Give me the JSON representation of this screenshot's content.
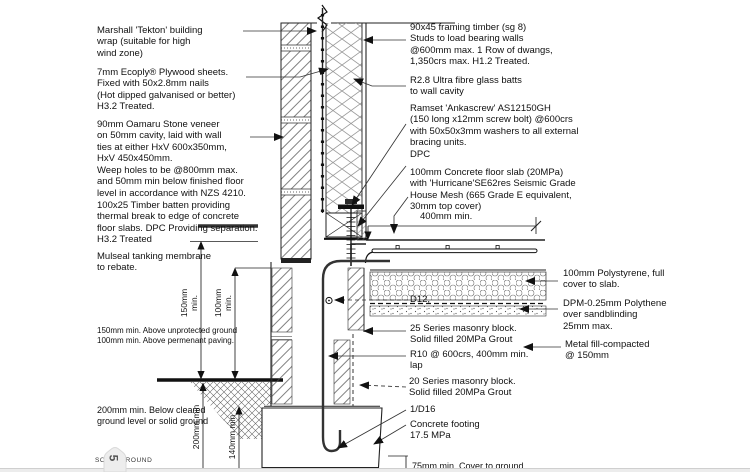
{
  "colors": {
    "ink": "#111111",
    "hatch": "#4a4a4a",
    "background": "#ffffff",
    "footer_strip": "#ececec",
    "pin_fill": "#ededed"
  },
  "left": {
    "building_wrap": "Marshall 'Tekton' building\nwrap (suitable for high\nwind zone)",
    "plywood": "7mm Ecoply® Plywood sheets.\nFixed with 50x2.8mm nails\n(Hot dipped galvanised or better)\nH3.2 Treated.",
    "stone_veneer": "90mm Oamaru Stone veneer\non 50mm cavity, laid with wall\nties at either HxV 600x350mm,\nHxV 450x450mm.\nWeep holes to be @800mm max.\nand 50mm min below finished floor\nlevel in accordance with NZS 4210.",
    "timber_batten": "100x25 Timber batten providing\nthermal break to edge of concrete\nfloor slabs. DPC Providing separation.\nH3.2 Treated",
    "tanking_membrane": "Mulseal tanking membrane\nto rebate.",
    "ground_clearance": "150mm min. Above unprotected ground\n100mm min. Above permenant paving.",
    "below_ground": "200mm min. Below cleared\nground level or solid ground",
    "solid_ground": "SOLID GROUND"
  },
  "right": {
    "framing": "90x45 framing timber (sg 8)\nStuds to load bearing walls\n@600mm max. 1 Row of dwangs,\n1,350crs max. H1.2 Treated.",
    "insulation": "R2.8 Ultra fibre glass batts\nto wall cavity",
    "anchor": "Ramset 'Ankascrew' AS12150GH\n(150 long x12mm screw bolt) @600crs\nwith 50x50x3mm washers to all external\nbracing units.",
    "dpc": "DPC",
    "floor_slab": "100mm Concrete floor slab (20MPa)\nwith 'Hurricane'SE62res Seismic Grade\nHouse Mesh (665 Grade E equivalent,\n30mm top cover)",
    "dim_400": "400mm min.",
    "d12_bar": "D12,",
    "block_25": "25 Series masonry block.\nSolid filled 20MPa Grout",
    "r10_bar": "R10 @ 600crs, 400mm min.\nlap",
    "block_20": "20 Series masonry block.\nSolid filled 20MPa Grout",
    "d16_bar": "1/D16",
    "footing": "Concrete footing\n17.5 MPa",
    "cover_75": "75mm min. Cover to ground",
    "polystyrene": "100mm Polystyrene, full\ncover to slab.",
    "dpm": "DPM-0.25mm Polythene\nover sandblinding\n25mm max.",
    "metal_fill": "Metal fill-compacted\n@ 150mm"
  },
  "dims": {
    "dim_150": "150mm\nmin.",
    "dim_100": "100mm\nmin.",
    "dim_200": "200mm min",
    "dim_140": "140mm min"
  },
  "pin": {
    "value": "5"
  }
}
